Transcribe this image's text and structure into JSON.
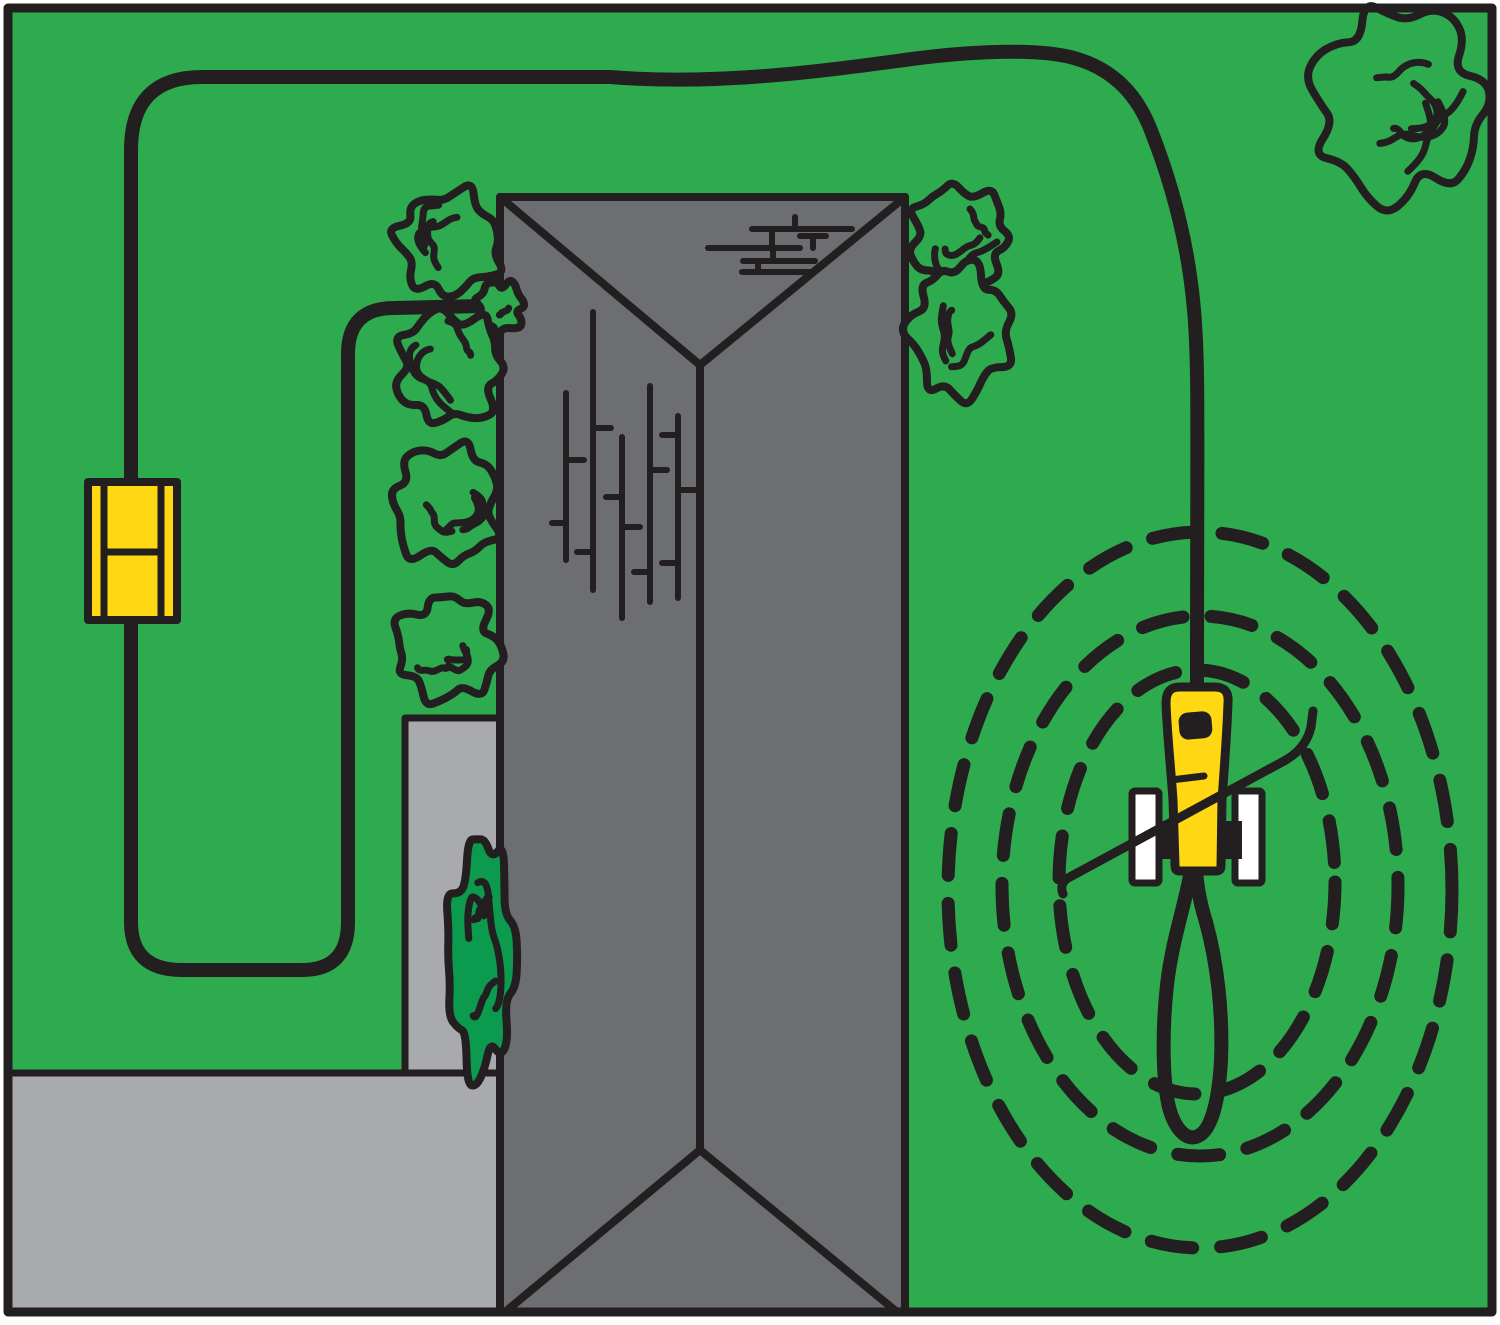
{
  "canvas": {
    "width": 1500,
    "height": 1325,
    "background": "#FFFFFF"
  },
  "palette": {
    "lawn": "#2FAB4F",
    "lightGray": "#A8AAAD",
    "roofGray": "#6D6E71",
    "accentYellow": "#FFD813",
    "ink": "#231F20",
    "white": "#FFFFFF",
    "bushGreen": "#0C9A4E"
  },
  "scene": {
    "description": "robotic-mower-yard-installation-diagram",
    "shapes": [
      {
        "name": "lawn",
        "type": "rect",
        "x": 8,
        "y": 8,
        "w": 1484,
        "h": 1304,
        "fill": "lawn"
      },
      {
        "name": "driveway",
        "type": "rect",
        "x": 8,
        "y": 1073,
        "w": 492,
        "h": 239,
        "fill": "lightGray",
        "stroke": "ink",
        "sw": 7
      },
      {
        "name": "patio",
        "type": "rect",
        "x": 405,
        "y": 718,
        "w": 95,
        "h": 355,
        "fill": "lightGray",
        "stroke": "ink",
        "sw": 7
      },
      {
        "name": "house-roof",
        "type": "rect",
        "x": 500,
        "y": 197,
        "w": 405,
        "h": 1115,
        "fill": "roofGray",
        "stroke": "ink",
        "sw": 8
      },
      {
        "name": "roof-ridge-lines",
        "type": "path",
        "d": "M 500,197 L 700,365 M 905,197 L 700,365 M 700,365 L 700,1150 M 700,1150 L 505,1312 M 700,1150 L 897,1312",
        "stroke": "ink",
        "sw": 8
      },
      {
        "name": "chimney-bricks",
        "type": "segments",
        "sw": 6,
        "stroke": "ink",
        "segs": [
          [
            795,
            217,
            795,
            229
          ],
          [
            752,
            229,
            852,
            229
          ],
          [
            708,
            248,
            800,
            248
          ],
          [
            772,
            229,
            772,
            248
          ],
          [
            813,
            236,
            813,
            248
          ],
          [
            800,
            236,
            826,
            236
          ],
          [
            743,
            261,
            815,
            261
          ],
          [
            773,
            248,
            773,
            261
          ],
          [
            742,
            272,
            813,
            272
          ],
          [
            758,
            261,
            758,
            272
          ]
        ]
      },
      {
        "name": "roof-shingle-texture",
        "type": "segments",
        "sw": 6,
        "stroke": "ink",
        "segs": [
          [
            566,
            393,
            566,
            560
          ],
          [
            552,
            523,
            566,
            523
          ],
          [
            566,
            460,
            584,
            460
          ],
          [
            593,
            312,
            593,
            590
          ],
          [
            593,
            428,
            611,
            428
          ],
          [
            577,
            552,
            593,
            552
          ],
          [
            622,
            437,
            622,
            618
          ],
          [
            606,
            497,
            622,
            497
          ],
          [
            622,
            527,
            640,
            527
          ],
          [
            650,
            386,
            650,
            602
          ],
          [
            650,
            470,
            667,
            470
          ],
          [
            634,
            572,
            650,
            572
          ],
          [
            678,
            416,
            678,
            598
          ],
          [
            662,
            435,
            678,
            435
          ],
          [
            678,
            490,
            695,
            490
          ],
          [
            662,
            563,
            678,
            563
          ]
        ]
      },
      {
        "name": "boundary-wire-perimeter",
        "type": "path",
        "d": "M 131,483 L 131,150 Q 131,77 202,77 L 610,77 C 720,86 830,70 912,59 C 980,50 1042,49 1074,58 Q 1128,73 1150,128 C 1170,178 1188,240 1194,310 C 1199,365 1197,430 1197,691",
        "stroke": "ink",
        "sw": 14
      },
      {
        "name": "boundary-wire-garden-loop",
        "type": "path",
        "d": "M 131,620 L 131,922 Q 131,970 182,970 L 302,970 Q 348,970 348,922 L 348,354 Q 348,308 394,308 L 481,306",
        "stroke": "ink",
        "sw": 14
      },
      {
        "name": "signal-circle-inner",
        "type": "ellipse",
        "cx": 1197,
        "cy": 882,
        "rx": 138,
        "ry": 212,
        "stroke": "ink",
        "sw": 13,
        "dash": "42 28"
      },
      {
        "name": "signal-circle-middle",
        "type": "ellipse",
        "cx": 1200,
        "cy": 886,
        "rx": 198,
        "ry": 270,
        "stroke": "ink",
        "sw": 13,
        "dash": "42 28"
      },
      {
        "name": "signal-circle-outer",
        "type": "ellipse",
        "cx": 1200,
        "cy": 890,
        "rx": 252,
        "ry": 358,
        "stroke": "ink",
        "sw": 13,
        "dash": "42 28"
      },
      {
        "name": "wire-loop-below-mower",
        "type": "path",
        "d": "M 1191,870 C 1186,902 1172,940 1167,985 C 1162,1030 1162,1088 1171,1114 C 1178,1133 1189,1141 1198,1136 C 1212,1130 1219,1098 1221,1060 C 1223,1012 1217,962 1206,922 C 1200,903 1197,886 1196,870",
        "stroke": "ink",
        "sw": 14
      },
      {
        "name": "bush-left-1",
        "type": "bush",
        "cx": 449,
        "cy": 243,
        "rx": 50,
        "ry": 50,
        "seed": 3,
        "inner": 3,
        "fill": "lawn",
        "stroke": "ink",
        "sw": 8
      },
      {
        "name": "bush-left-small",
        "type": "bush",
        "cx": 500,
        "cy": 307,
        "rx": 23,
        "ry": 25,
        "seed": 5,
        "inner": 1,
        "fill": "lawn",
        "stroke": "ink",
        "sw": 8
      },
      {
        "name": "bush-left-2",
        "type": "bush",
        "cx": 449,
        "cy": 367,
        "rx": 52,
        "ry": 55,
        "seed": 8,
        "inner": 3,
        "fill": "lawn",
        "stroke": "ink",
        "sw": 8
      },
      {
        "name": "bush-left-3",
        "type": "bush",
        "cx": 446,
        "cy": 504,
        "rx": 52,
        "ry": 58,
        "seed": 12,
        "inner": 3,
        "fill": "lawn",
        "stroke": "ink",
        "sw": 8
      },
      {
        "name": "bush-left-4",
        "type": "bush",
        "cx": 448,
        "cy": 648,
        "rx": 51,
        "ry": 51,
        "seed": 14,
        "inner": 3,
        "fill": "lawn",
        "stroke": "ink",
        "sw": 8
      },
      {
        "name": "bush-right-1",
        "type": "bush",
        "cx": 959,
        "cy": 236,
        "rx": 48,
        "ry": 49,
        "seed": 21,
        "inner": 3,
        "fill": "lawn",
        "stroke": "ink",
        "sw": 8
      },
      {
        "name": "bush-right-2",
        "type": "bush",
        "cx": 960,
        "cy": 331,
        "rx": 49,
        "ry": 64,
        "seed": 23,
        "inner": 3,
        "fill": "lawn",
        "stroke": "ink",
        "sw": 8
      },
      {
        "name": "tree-top-right",
        "type": "bush",
        "cx": 1399,
        "cy": 104,
        "rx": 84,
        "ry": 94,
        "seed": 31,
        "inner": 5,
        "fill": "lawn",
        "stroke": "ink",
        "sw": 8
      },
      {
        "name": "bush-dark-patio",
        "type": "bush",
        "cx": 481,
        "cy": 957,
        "rx": 33,
        "ry": 114,
        "seed": 41,
        "inner": 4,
        "fill": "bushGreen",
        "stroke": "ink",
        "sw": 8
      },
      {
        "name": "charging-station-body",
        "type": "rect",
        "x": 88,
        "y": 482,
        "w": 89,
        "h": 138,
        "fill": "accentYellow",
        "stroke": "ink",
        "sw": 8
      },
      {
        "name": "charging-station-contacts",
        "type": "segments",
        "sw": 7,
        "stroke": "ink",
        "segs": [
          [
            104,
            482,
            104,
            620
          ],
          [
            161,
            482,
            161,
            620
          ],
          [
            104,
            552,
            161,
            552
          ]
        ]
      },
      {
        "name": "mower-body",
        "type": "path",
        "d": "M 1166,703 C 1166,690 1172,687 1180,687 L 1214,687 C 1224,687 1229,691 1228,703 C 1227,733 1224,772 1222,800 L 1221,866 C 1221,870 1219,871 1216,871 L 1180,871 C 1176,871 1175,869 1175,865 L 1173,800 C 1171,770 1167,733 1166,703 Z",
        "fill": "accentYellow",
        "stroke": "ink",
        "sw": 9
      },
      {
        "name": "mower-window",
        "type": "rect",
        "x": 1179,
        "y": 712,
        "w": 33,
        "h": 27,
        "rx": 9,
        "fill": "ink",
        "transform": "rotate(-5 1195 726)"
      },
      {
        "name": "mower-body-seam",
        "type": "path",
        "d": "M 1171,780 L 1204,776",
        "stroke": "ink",
        "sw": 7
      },
      {
        "name": "mower-wheel-left",
        "type": "rect",
        "x": 1132,
        "y": 791,
        "w": 27,
        "h": 92,
        "rx": 3,
        "fill": "white",
        "stroke": "ink",
        "sw": 7
      },
      {
        "name": "mower-wheel-right",
        "type": "rect",
        "x": 1235,
        "y": 791,
        "w": 27,
        "h": 92,
        "rx": 3,
        "fill": "white",
        "stroke": "ink",
        "sw": 7
      },
      {
        "name": "mower-axle-left",
        "type": "rect",
        "x": 1157,
        "y": 821,
        "w": 19,
        "h": 38,
        "fill": "ink"
      },
      {
        "name": "mower-axle-right",
        "type": "rect",
        "x": 1223,
        "y": 821,
        "w": 19,
        "h": 38,
        "fill": "ink"
      },
      {
        "name": "mower-path-line",
        "type": "path",
        "d": "M 1063,894 Q 1059,884 1068,878 L 1284,761 Q 1306,749 1311,727 L 1313,711",
        "stroke": "ink",
        "sw": 9
      },
      {
        "name": "picture-frame",
        "type": "rect",
        "x": 8,
        "y": 8,
        "w": 1484,
        "h": 1304,
        "stroke": "ink",
        "sw": 9
      }
    ]
  }
}
